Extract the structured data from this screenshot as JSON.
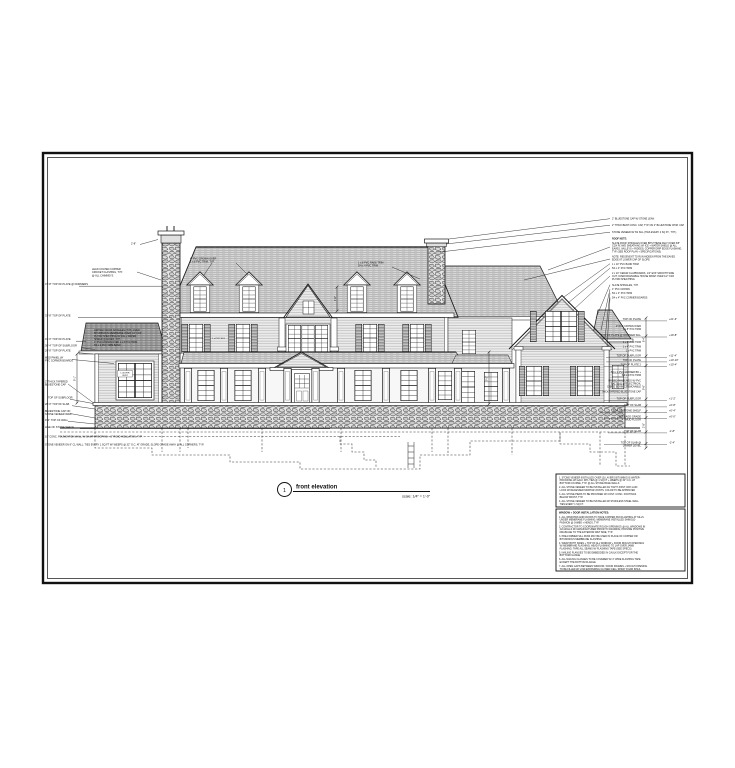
{
  "sheet": {
    "number": "1",
    "title": "front elevation",
    "scale": "scale: 1/4\" = 1'-0\""
  },
  "left": {
    "chimney_flashing": [
      "LEAD COATED COPPER",
      "CRICKET FLASHING, TYP.",
      "@ ALL CHIMNEYS"
    ],
    "rows": [
      "37'-8\"   TOP OF PLATE @ DORMERS",
      "33'-8\"   TOP OF PLATE",
      "31'-0\"   TOP OF PLATE",
      "30'-4\"   TOP OF SUBFLOOR",
      "29'-8\"   TOP OF PLATE",
      "TOP OF SUBFLOOR",
      "28'-0\"   TOP OF SLAB",
      "9'-4\"   TOP OF WALL",
      "LINE OF STONE SHELF"
    ],
    "mdo_panel": [
      "MDO PANEL W/",
      "PVC CORNER BOARDS"
    ],
    "bluestone_cap": [
      "2\" THICK TAPERED",
      "BLUESTONE CAP"
    ],
    "cap_on_wall": [
      "BLUESTONE CAP ON",
      "STONE VENEER WALL"
    ],
    "foundation_note": "10\" CONC. FOUNDATION WALL W/ DAMP-PROOFING + 2\" RIGID INSULATION, TYP.",
    "veneer_note": "STONE VENEER ON 8\" CL WALL, TIES EVERY 1 SQ FT W/ WEEPS @ 32\" O.C. AT GRADE, SLOPE GRADE AWAY @ ALL CORNERS, TYP."
  },
  "top": {
    "pvc_crown": [
      "4\" PVC CROWN OVER",
      "1 x 8 PVC TRIM, TYP."
    ],
    "rake_trim": [
      "1 x 8 PVC RAKE TRIM",
      "5/4 x 4 PVC TRIM"
    ]
  },
  "wing_roof_note": [
    "ASPHALT ROOF SHINGLES (TYP.) OVER",
    "BITUMINOUS MEMBRANE OVER 1/2\" CDX",
    "PLYWD SHEATHING W/ ICE + WATER",
    "SHIELD @ EAVES, TYP.",
    "4\" PVC CROWN OVER 1 x 8 PVC TRIM",
    "5/4 x 4 PVC TRIM BAND"
  ],
  "interior_labels": {
    "louver": [
      "LOUVER",
      "VENT"
    ],
    "sill": "1 x PVC SILL"
  },
  "right_callouts": {
    "c0": "2\" BLUESTONE CAP W/ STONE LEAN",
    "c1": "2\" THICK BENT CONC. CAP, TYP. ON 2\" BLUESTONE CHIM. CAP",
    "c2": "STONE VENEER W/ SS SILL (TIES EVERY 2 SQ FT., TYP.)",
    "c3": "ROOF NOTE:",
    "c4": [
      "SLATE ROOF SHINGLES OVER BITUTHENE FELT OVER 5/8\"",
      "CDX PLYWD SHEATHING W/ ICE + WATER SHIELD @ ALL",
      "EAVES, VALLEYS + RIDGES; COPPER DRIP EDGE FLASHING,",
      "TYP. (SEE ROOF PLAN + SPECIFICATIONS)"
    ],
    "c5": [
      "NOTE: RIDGEVENT TO RUN HIDDEN FROM THE EAVES",
      "EDGE AT LOWER CAP OF SLOPE"
    ],
    "c6": "1 x 10\" PVC BAND TRIM",
    "c7": "5/4 x 4\" PVC TRIM",
    "c8": [
      "2 x 10\" CEDAR CLAPBOARDS, 1/2\" EXP. SMOOTH SIDE",
      "OUT, OVER DRAINABLE HOUSE WRAP OVER 1/2\" CDX",
      "PLYWD SHEATHING"
    ],
    "c9": "SLATE SHINGLES, TYP.",
    "c10": "4\" PVC CROWN",
    "c11": "5/4 x 4\" PVC TRIM",
    "c12": "5/4 x 4\" PVC CORNER BOARDS"
  },
  "levels": {
    "r0": {
      "label": "TOP OF PLATE",
      "value": "+21'-6\""
    },
    "r1": [
      "2\" PVC CROWN OVER",
      "1 x 8\" PVC TRIM"
    ],
    "r2": {
      "label": "TOP OF PLATE @ DORMER SILL",
      "value": "+19'-8\""
    },
    "r3": "1 x 8\" PVC TRIM",
    "r4": "1 x 4\" PVC TRIM",
    "r5": "1 x PVC TRIM",
    "r6": {
      "label": "TOP OF SUBFLOOR",
      "value": "+11'-4\""
    },
    "r7": {
      "label": "TOP OF PLATE",
      "value": "+10'-10\""
    },
    "r8": {
      "label": "TOP OF PLATE 2",
      "value": "+10'-4\""
    },
    "r9": [
      "5/4 x 4 PVC CORNER BD +",
      "5/4 x 4 PVC TRIM"
    ],
    "r10": [
      "RAISED PANEL MDO W/ PVC",
      "BATTENS W/ ELECTRICAL",
      "CHASE BEHIND, REMOVABLE"
    ],
    "r11": "2\" THICK TAPERED BLUESTONE CAP",
    "r12": {
      "label": "TOP OF SUBFLOOR",
      "value": "+1'-2\""
    },
    "r13": {
      "label": "TOP OF SLAB",
      "value": "+0'-8\""
    },
    "r14": {
      "label": "TOP OF STONE SHELF",
      "value": "+0'-4\""
    },
    "r15": {
      "label": [
        "AVERAGE GRADE",
        "MUD FLOOR"
      ],
      "value": "+0'-0\""
    },
    "r16": {
      "label": "TOP OF SLAB",
      "value": "-1'-8\""
    },
    "r17": {
      "label": [
        "TOP OF SLAB @",
        "LOWER LEVEL"
      ],
      "value": "-2'-4\""
    }
  },
  "dims": {
    "chimney": "2'-8\"",
    "left_story": "9'-1\"",
    "wing_story": "9'-0\"",
    "dormer": "4'-6\"",
    "right_upper": "8'-4\"",
    "right_mid": "9'-6\"",
    "right_low": "2'-8\""
  },
  "notes1": {
    "items": [
      [
        "1.  STONE VENEER INSTALLED OVER (2) LAYERS BITUMINOUS WATER-",
        "     PROOFING W/ GALV. MTL TIES @ 1 SQ FT + WEEPS @ 32\" O.C. AT",
        "     BOTTOM COURSE, TYP. @ ALL STONE BASE WALLS"
      ],
      [
        "2.  ALL STONE VENEER TO BE INSTALLED AS TIGHT JOINT, DRY-LAID",
        "     LOOK W/ RECESSED MORTAR JOINTS, COLOR TO BE APPROVED"
      ],
      [
        "3.  ALL STONE PIERS TO BE PROVIDED W/ CONT. CONC. FOOTINGS",
        "     BELOW FROST, TYP."
      ],
      [
        "4.  ALL STONE VENEER TO BE INSTALLED W/ STAINLESS STEEL WALL",
        "     TIES EVERY 1 SQ FT."
      ]
    ]
  },
  "notes2": {
    "heading": "WINDOW + DOOR INSTALLATION NOTES:",
    "items": [
      [
        "1.  ALL WINDOWS AND DOORS TO HAVE COPPER PAN FLASHING AT SILLS",
        "     UNDER MEMBRANE FLASHING; MEMBRANE INSTALLED SHINGLE-",
        "     FASHION @ JAMBS + HEADS, TYP."
      ],
      [
        "2.  CONTRACTOR TO COORDINATE ROUGH OPENINGS @ ALL WINDOWS IN",
        "     2x6 WALLS W/ MANUFACTURER PRIOR TO FRAMING; PROVIDE POSITIVE",
        "     DRAINAGE TO THE EXTERIOR WET SIDE, TYP."
      ],
      [
        "3.  PRE-FORMED SILL PANS MAY BE USED IN PLACE OF COPPER OR",
        "     BITUMINOUS MEMBRANE FLASHING"
      ],
      [
        "4.  WRAP BOTH SIDES + TOP OF ALL WINDOW + DOOR ROUGH OPENINGS",
        "     W/ MEMBRANE FLASHING; HEAD FLASHING TO LAP OVER JAMB",
        "     FLASHING; TAPE ALL SEAMS W/ FLASHING TAPE (SEE SPECS)"
      ],
      [
        "5.  NAILING FLANGES TO BE EMBEDDED IN CAULK EXCEPT FOR THE",
        "     BOTTOM FLANGE"
      ],
      [
        "6.  ALL NAILING FLANGES TO BE COVERED W/ 4\" WIDE FLASHING TAPE",
        "     EXCEPT THE BOTTOM FLANGE"
      ],
      [
        "7.  ALL OPEN GAPS BETWEEN WINDOW / DOOR FRAMES + ROUGH OPENING",
        "     TO BE FILLED W/ LOW-EXPANDING CLOSED CELL SPRAY FOAM INSUL."
      ]
    ]
  }
}
